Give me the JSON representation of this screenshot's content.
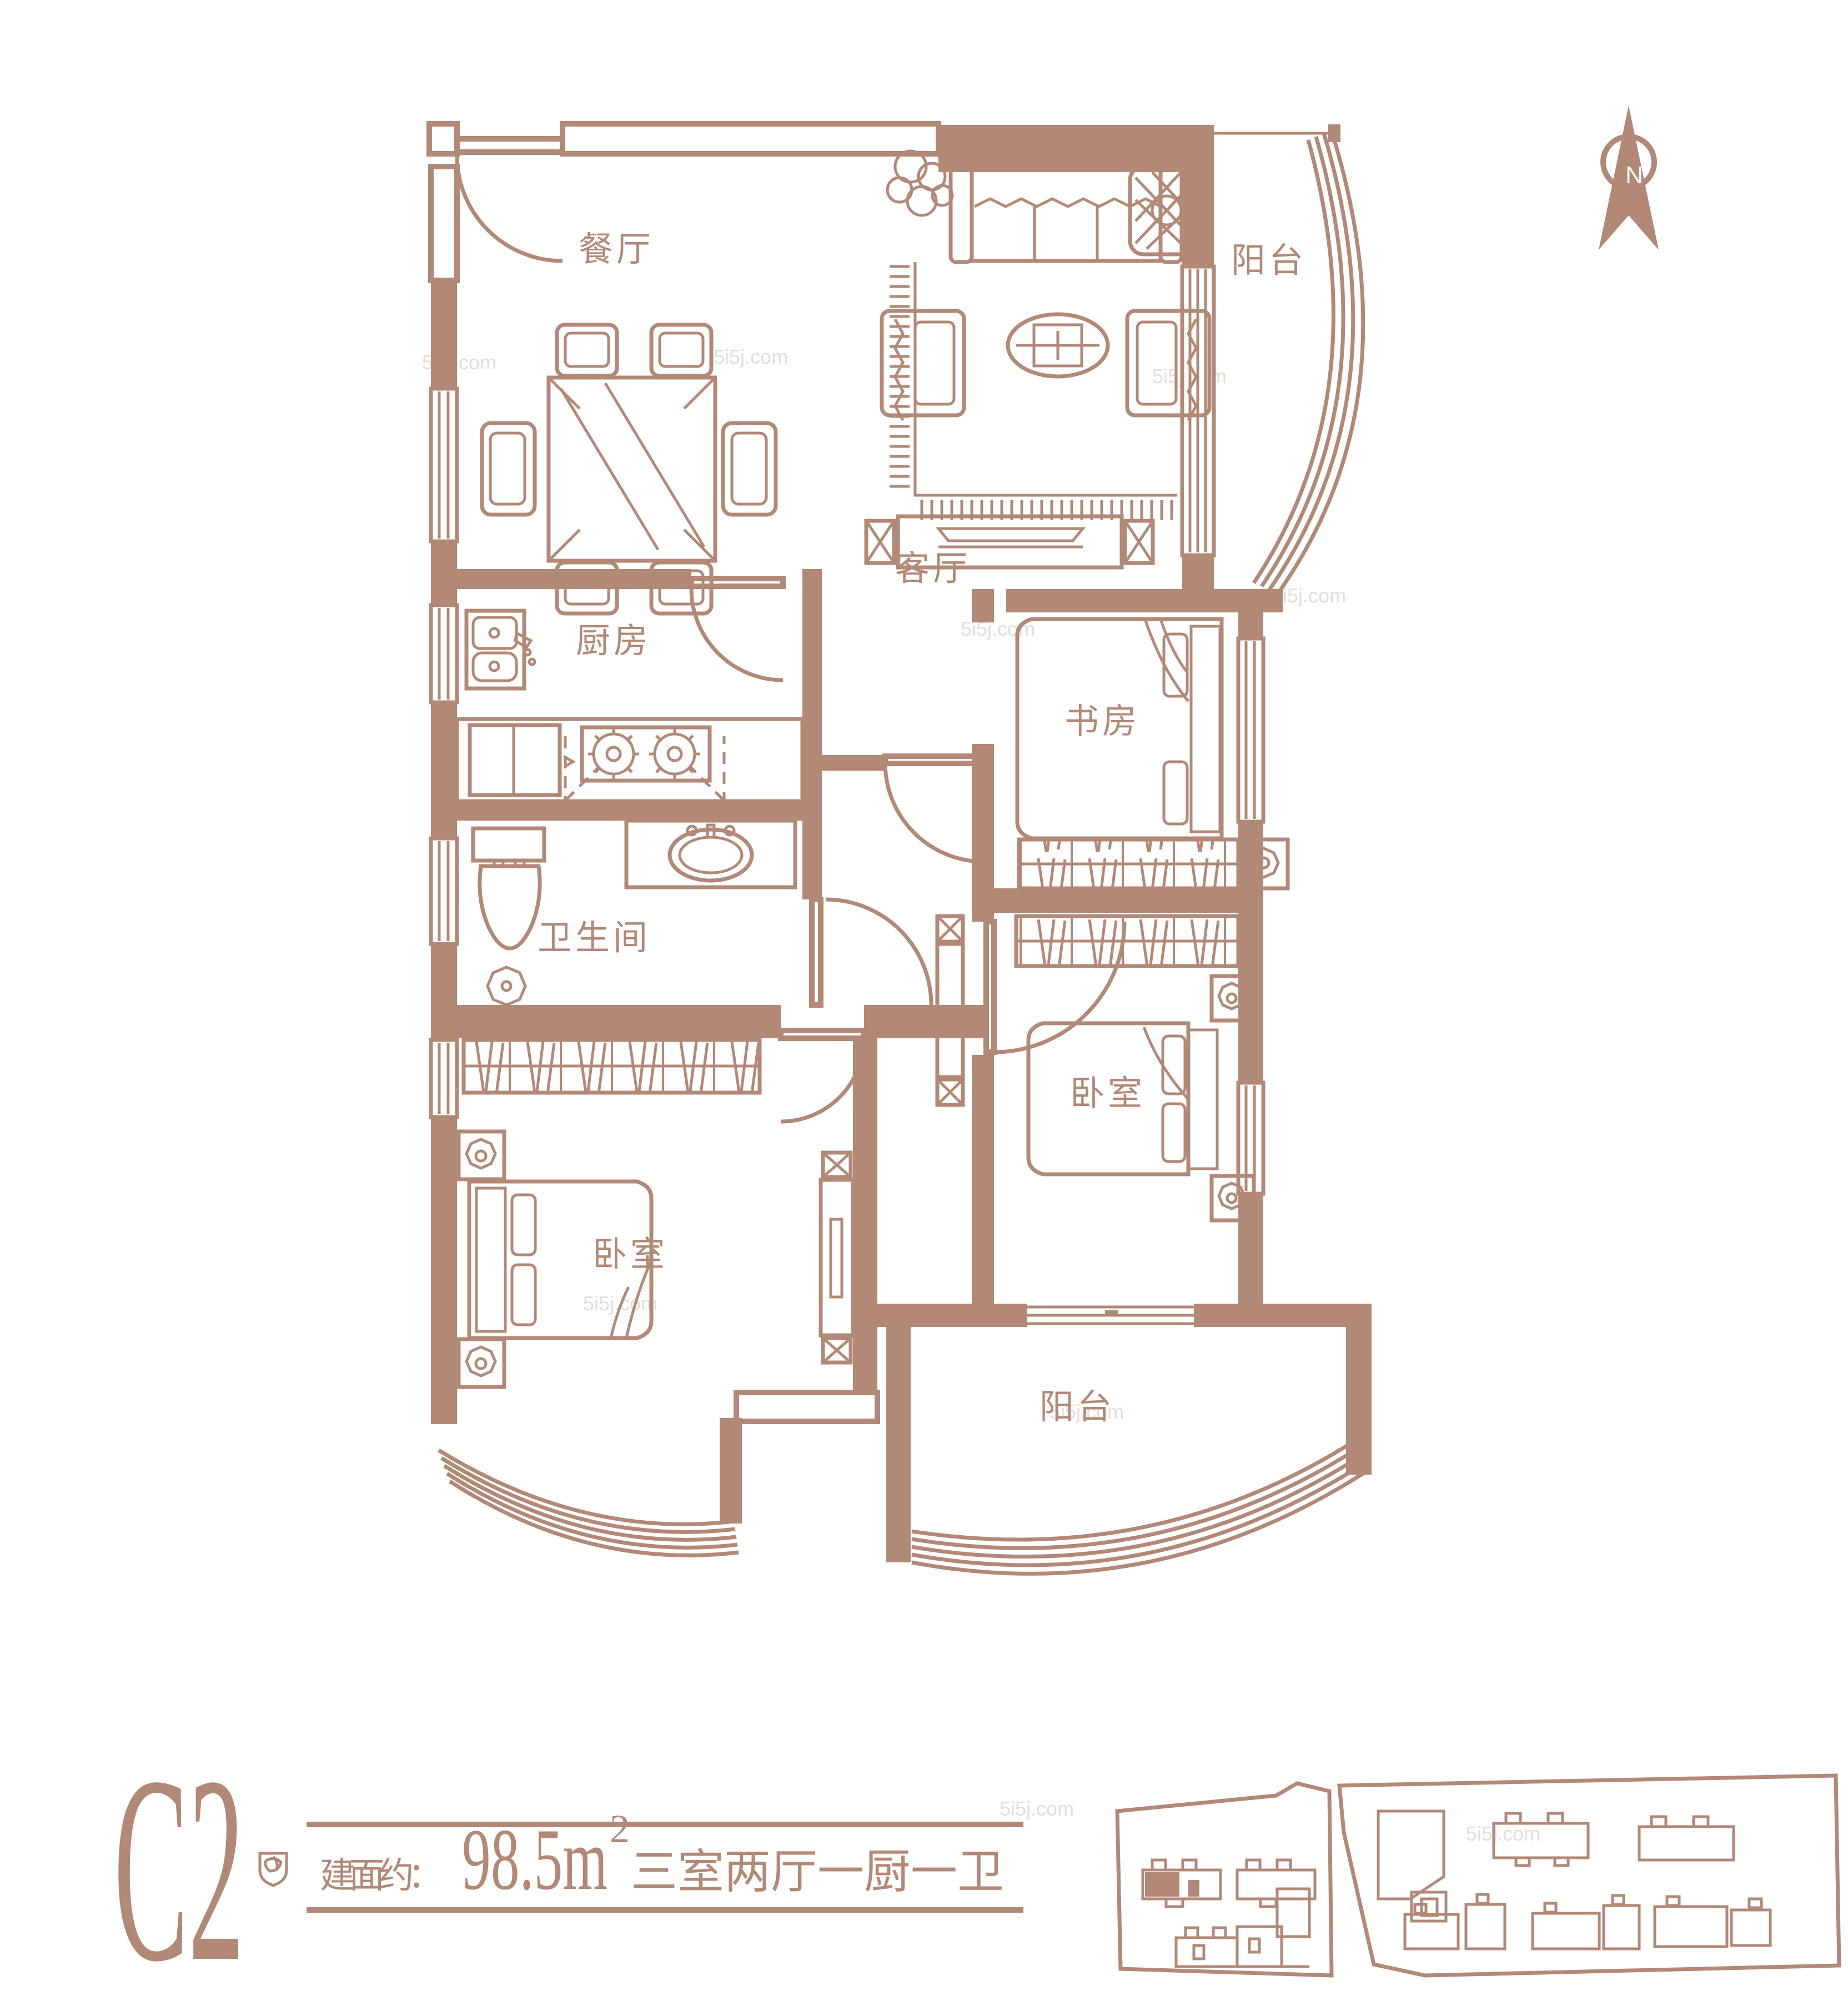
{
  "colors": {
    "accent": "#b28877",
    "watermark": "#cfc2ba",
    "compass_letter": "#ffffff"
  },
  "watermark": "5i5j.com",
  "compass": {
    "letter": "N"
  },
  "rooms": {
    "dining": "餐厅",
    "living": "客厅",
    "balcony_top": "阳台",
    "kitchen": "厨房",
    "bath": "卫生间",
    "study": "书房",
    "bedroom_left": "卧室",
    "bedroom_right": "卧室",
    "balcony_bottom": "阳台"
  },
  "footer": {
    "unit": "C2",
    "area_label": "建面约：",
    "area_value": "98.5m",
    "area_sup": "2",
    "layout_desc": "三室两厅一厨一卫"
  }
}
